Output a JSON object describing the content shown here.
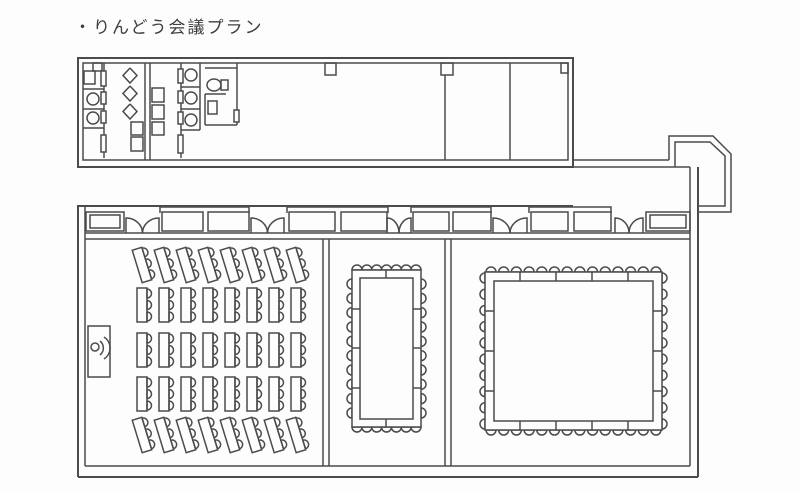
{
  "page": {
    "title": "・りんどう会議プラン"
  },
  "plan": {
    "stroke": "#4b4b4b",
    "groups": [
      {
        "name": "upper-block-outline",
        "shapes": [
          {
            "t": "rect",
            "d": [
              78,
              58,
              495,
              109
            ],
            "w": 2
          },
          {
            "t": "rect",
            "d": [
              83,
              63,
              485,
              97
            ],
            "w": 1.5
          }
        ]
      },
      {
        "name": "upper-block-pillars",
        "shapes": [
          {
            "t": "rect",
            "d": [
              93,
              63,
              9,
              8
            ]
          },
          {
            "t": "rect",
            "d": [
              325,
              63,
              11,
              12
            ]
          },
          {
            "t": "rect",
            "d": [
              441,
              63,
              12,
              12
            ]
          },
          {
            "t": "rect",
            "d": [
              561,
              63,
              7,
              10
            ]
          }
        ]
      },
      {
        "name": "upper-block-room-dividers",
        "shapes": [
          {
            "t": "line",
            "d": [
              445,
              75,
              445,
              160
            ]
          },
          {
            "t": "line",
            "d": [
              510,
              63,
              510,
              160
            ]
          }
        ]
      },
      {
        "name": "restroom-left-stalls",
        "shapes": [
          {
            "t": "line",
            "d": [
              104,
              63,
              104,
              158
            ]
          },
          {
            "t": "line",
            "d": [
              83,
              89,
              104,
              89
            ]
          },
          {
            "t": "line",
            "d": [
              83,
              109,
              104,
              109
            ]
          },
          {
            "t": "line",
            "d": [
              83,
              128,
              104,
              128
            ]
          },
          {
            "t": "rect",
            "d": [
              84,
              71,
              11,
              13
            ]
          },
          {
            "t": "circle",
            "d": [
              93,
              99,
              6
            ]
          },
          {
            "t": "circle",
            "d": [
              93,
              118,
              6
            ]
          },
          {
            "t": "rect",
            "d": [
              101,
              71,
              5,
              15
            ],
            "f": 1
          },
          {
            "t": "rect",
            "d": [
              101,
              92,
              5,
              12
            ],
            "f": 1
          },
          {
            "t": "rect",
            "d": [
              101,
              111,
              5,
              12
            ],
            "f": 1
          },
          {
            "t": "rect",
            "d": [
              101,
              135,
              5,
              17
            ],
            "f": 1
          }
        ]
      },
      {
        "name": "restroom-urinals",
        "shapes": [
          {
            "t": "poly",
            "d": [
              [
                130,
                68
              ],
              [
                137,
                75.5
              ],
              [
                130,
                83
              ],
              [
                123,
                75.5
              ],
              [
                130,
                68
              ]
            ]
          },
          {
            "t": "poly",
            "d": [
              [
                130,
                86
              ],
              [
                137,
                93.5
              ],
              [
                130,
                101
              ],
              [
                123,
                93.5
              ],
              [
                130,
                86
              ]
            ]
          },
          {
            "t": "poly",
            "d": [
              [
                130,
                104
              ],
              [
                137,
                111.5
              ],
              [
                130,
                119
              ],
              [
                123,
                111.5
              ],
              [
                130,
                104
              ]
            ]
          },
          {
            "t": "rect",
            "d": [
              131,
              122,
              12,
              13
            ]
          },
          {
            "t": "rect",
            "d": [
              131,
              137,
              12,
              14
            ]
          }
        ]
      },
      {
        "name": "restroom-partition-wall",
        "shapes": [
          {
            "t": "line",
            "d": [
              145,
              63,
              145,
              160
            ]
          },
          {
            "t": "line",
            "d": [
              150,
              63,
              150,
              160
            ]
          }
        ]
      },
      {
        "name": "restroom-sinks",
        "shapes": [
          {
            "t": "rect",
            "d": [
              152,
              88,
              12,
              14
            ]
          },
          {
            "t": "rect",
            "d": [
              152,
              105,
              12,
              14
            ]
          },
          {
            "t": "rect",
            "d": [
              152,
              122,
              12,
              13
            ]
          }
        ]
      },
      {
        "name": "restroom-right-stalls",
        "shapes": [
          {
            "t": "line",
            "d": [
              181,
              63,
              181,
              158
            ]
          },
          {
            "t": "line",
            "d": [
              200,
              63,
              200,
              130
            ]
          },
          {
            "t": "line",
            "d": [
              181,
              87,
              200,
              87
            ]
          },
          {
            "t": "line",
            "d": [
              181,
              109,
              200,
              109
            ]
          },
          {
            "t": "line",
            "d": [
              181,
              130,
              200,
              130
            ]
          },
          {
            "t": "circle",
            "d": [
              191,
              75,
              6
            ]
          },
          {
            "t": "circle",
            "d": [
              191,
              98,
              6
            ]
          },
          {
            "t": "circle",
            "d": [
              191,
              120,
              6
            ]
          },
          {
            "t": "rect",
            "d": [
              178,
              69,
              5,
              14
            ],
            "f": 1
          },
          {
            "t": "rect",
            "d": [
              178,
              91,
              5,
              12
            ],
            "f": 1
          },
          {
            "t": "rect",
            "d": [
              178,
              112,
              5,
              12
            ],
            "f": 1
          },
          {
            "t": "rect",
            "d": [
              178,
              135,
              5,
              18
            ],
            "f": 1
          }
        ]
      },
      {
        "name": "accessible-restroom",
        "shapes": [
          {
            "t": "line",
            "d": [
              205,
              68,
              237,
              68
            ]
          },
          {
            "t": "line",
            "d": [
              237,
              63,
              237,
              125
            ]
          },
          {
            "t": "ellipse",
            "d": [
              214,
              85,
              7,
              6
            ]
          },
          {
            "t": "rect",
            "d": [
              221,
              80,
              7,
              10
            ]
          },
          {
            "t": "line",
            "d": [
              205,
              94,
              226,
              94
            ]
          },
          {
            "t": "line",
            "d": [
              205,
              94,
              205,
              125
            ]
          },
          {
            "t": "line",
            "d": [
              205,
              125,
              237,
              125
            ]
          },
          {
            "t": "rect",
            "d": [
              208,
              101,
              9,
              13
            ]
          },
          {
            "t": "rect",
            "d": [
              234,
              110,
              5,
              12
            ],
            "f": 1
          }
        ]
      },
      {
        "name": "corridor-and-entry",
        "shapes": [
          {
            "t": "line",
            "d": [
              573,
              160,
              669,
              160
            ]
          },
          {
            "t": "line",
            "d": [
              573,
              167,
              690,
              167
            ]
          },
          {
            "t": "poly",
            "d": [
              [
                669,
                160
              ],
              [
                669,
                136
              ],
              [
                713,
                136
              ],
              [
                731,
                154
              ],
              [
                731,
                212
              ],
              [
                698,
                212
              ]
            ]
          },
          {
            "t": "poly",
            "d": [
              [
                675,
                167
              ],
              [
                675,
                142
              ],
              [
                710,
                142
              ],
              [
                725,
                156
              ],
              [
                725,
                206
              ],
              [
                698,
                206
              ]
            ]
          }
        ]
      },
      {
        "name": "lower-block-outline",
        "shapes": [
          {
            "t": "line",
            "d": [
              78,
              206,
              573,
              206
            ],
            "w": 2
          },
          {
            "t": "line",
            "d": [
              78,
              205,
              78,
              477
            ],
            "w": 2
          },
          {
            "t": "line",
            "d": [
              78,
              477,
              698,
              477
            ],
            "w": 2
          },
          {
            "t": "line",
            "d": [
              698,
              167,
              698,
              477
            ],
            "w": 2
          },
          {
            "t": "line",
            "d": [
              85,
              207,
              85,
              466
            ]
          },
          {
            "t": "line",
            "d": [
              85,
              466,
              690,
              466
            ]
          },
          {
            "t": "line",
            "d": [
              690,
              167,
              690,
              466
            ]
          },
          {
            "t": "line",
            "d": [
              85,
              233,
              690,
              233
            ]
          },
          {
            "t": "line",
            "d": [
              85,
              239,
              690,
              239
            ]
          }
        ]
      },
      {
        "name": "room-divider-walls",
        "shapes": [
          {
            "t": "line",
            "d": [
              323,
              239,
              323,
              466
            ]
          },
          {
            "t": "line",
            "d": [
              329,
              239,
              329,
              466
            ]
          },
          {
            "t": "line",
            "d": [
              445,
              239,
              445,
              466
            ]
          },
          {
            "t": "line",
            "d": [
              451,
              239,
              451,
              466
            ]
          }
        ]
      },
      {
        "name": "window-door-band",
        "shapes": [
          {
            "t": "band",
            "base_y": 233,
            "win_y": 212,
            "win_h": 19,
            "items": [
              {
                "t": "window",
                "x": 86,
                "w": 38,
                "nested": true
              },
              {
                "t": "door",
                "x": 126,
                "w": 33
              },
              {
                "t": "lintel",
                "x1": 160,
                "x2": 249
              },
              {
                "t": "window",
                "x": 162,
                "w": 41
              },
              {
                "t": "window",
                "x": 208,
                "w": 41
              },
              {
                "t": "door",
                "x": 251,
                "w": 33
              },
              {
                "t": "lintel",
                "x1": 287,
                "x2": 388
              },
              {
                "t": "window",
                "x": 289,
                "w": 46
              },
              {
                "t": "window",
                "x": 341,
                "w": 46
              },
              {
                "t": "door",
                "x": 387,
                "w": 24
              },
              {
                "t": "lintel",
                "x1": 411,
                "x2": 491
              },
              {
                "t": "window",
                "x": 413,
                "w": 36
              },
              {
                "t": "window",
                "x": 453,
                "w": 38
              },
              {
                "t": "door",
                "x": 493,
                "w": 34
              },
              {
                "t": "lintel",
                "x1": 529,
                "x2": 611
              },
              {
                "t": "window",
                "x": 531,
                "w": 37
              },
              {
                "t": "window",
                "x": 574,
                "w": 37
              },
              {
                "t": "door",
                "x": 615,
                "w": 28
              },
              {
                "t": "window",
                "x": 646,
                "w": 44,
                "nested": true
              }
            ]
          }
        ]
      },
      {
        "name": "lectern",
        "shapes": [
          {
            "t": "rect",
            "d": [
              88,
              326,
              22,
              51
            ],
            "f": 1
          },
          {
            "t": "circle",
            "d": [
              95,
              347,
              4
            ]
          },
          {
            "t": "path",
            "d": "M 100 341 A 9 9 0 0 1 100 355"
          },
          {
            "t": "path",
            "d": "M 104 337 A 13 13 0 0 1 104 359"
          }
        ]
      },
      {
        "name": "classroom-seating",
        "shapes": [
          {
            "t": "classroom",
            "cols": 8,
            "x0": 142,
            "dx": 22,
            "tw": 10,
            "th": 34,
            "cr": 4.5,
            "cdy": 11.5,
            "rows": [
              {
                "cy": 265,
                "tilt": -17
              },
              {
                "cy": 305,
                "tilt": 0
              },
              {
                "cy": 350,
                "tilt": 0
              },
              {
                "cy": 394,
                "tilt": 0
              },
              {
                "cy": 435,
                "tilt": -17
              }
            ]
          }
        ]
      },
      {
        "name": "medium-boardroom-table",
        "shapes": [
          {
            "t": "ring",
            "outer": [
              352,
              270,
              69,
              157
            ],
            "th": 8,
            "cr": 5,
            "div": {
              "top": [
                386
              ],
              "bottom": [
                386
              ],
              "left": [
                309,
                348,
                388
              ],
              "right": [
                309,
                348,
                388
              ]
            },
            "chairs": {
              "top": {
                "n": 7,
                "a": 357,
                "b": 416
              },
              "bottom": {
                "n": 7,
                "a": 357,
                "b": 416
              },
              "left": {
                "n": 10,
                "a": 284,
                "b": 413
              },
              "right": {
                "n": 10,
                "a": 284,
                "b": 413
              }
            }
          }
        ]
      },
      {
        "name": "large-boardroom-table",
        "shapes": [
          {
            "t": "ring",
            "outer": [
              485,
              272,
              177,
              158
            ],
            "th": 9,
            "cr": 5,
            "div": {
              "top": [
                520,
                556,
                592,
                628
              ],
              "bottom": [
                520,
                556,
                592,
                628
              ],
              "left": [
                311,
                351,
                391
              ],
              "right": [
                311,
                351,
                391
              ]
            },
            "chairs": {
              "top": {
                "n": 14,
                "a": 491,
                "b": 656
              },
              "bottom": {
                "n": 14,
                "a": 491,
                "b": 656
              },
              "left": {
                "n": 10,
                "a": 278,
                "b": 424
              },
              "right": {
                "n": 10,
                "a": 278,
                "b": 424
              }
            }
          }
        ]
      }
    ]
  }
}
